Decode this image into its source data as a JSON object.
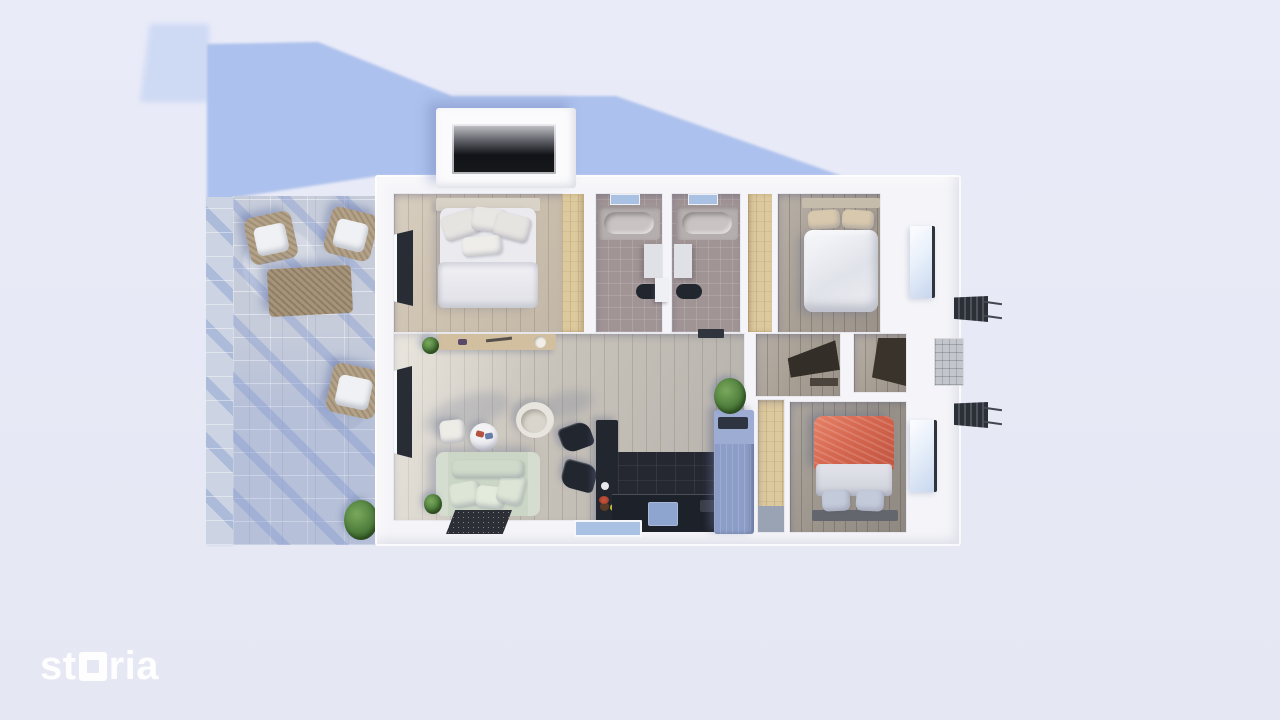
{
  "branding": {
    "logo_prefix": "st",
    "logo_suffix": "ria",
    "logo_full": "storia"
  },
  "palette": {
    "bg": "#e9ebf8",
    "bg_bottom": "#e5e7f3",
    "shadow_blue": "#a9bfec",
    "shadow_soft": "#c9d6f3",
    "wall": "#f5f5f9",
    "wall_bright": "#fbfbfd",
    "wood_living": "#c8c3ba",
    "wood_warm": "#cdc1af",
    "wood_gray": "#a89f94",
    "wood_gray_dark": "#9b948b",
    "pine": "#ddc99e",
    "tile_mauve": "#a19495",
    "dark_navy": "#22262f",
    "counter_dark": "#1d2129",
    "sofa_sage": "#cbd6c6",
    "sofa_cushion": "#dce5d6",
    "bed_white": "#eaeaef",
    "bed_red": "#d5664f",
    "pillow_beige": "#d8c9ae",
    "pillow_blue": "#c3cada",
    "fridge_blue": "#8c9dc7",
    "stone": "#c6ccda",
    "stone_step": "#ccd3e2",
    "rattan": "#b3a288",
    "cushion_white": "#eff1f4",
    "plant_green": "#4e7d3c",
    "rug_dark": "#2c2f36",
    "window_dark": "#272c35",
    "window_bright": "#e8f0fa",
    "sill_blue": "#a9c2e4",
    "tub_gray": "#c9c3c3",
    "logo_white": "#ffffff"
  }
}
